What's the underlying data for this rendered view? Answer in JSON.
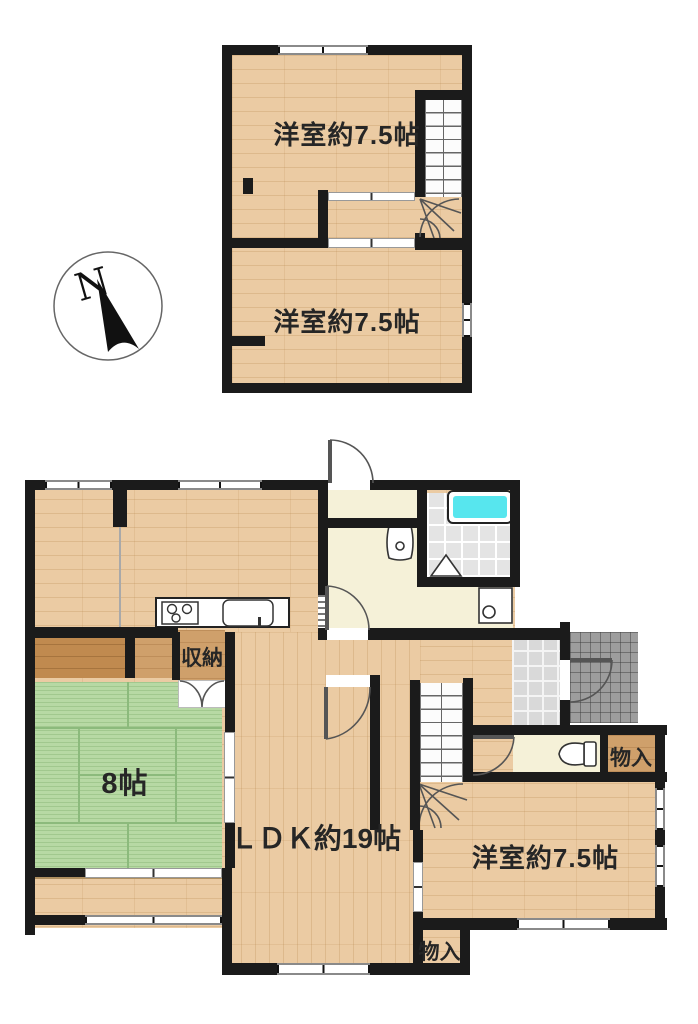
{
  "compass": {
    "label": "N"
  },
  "floor2": {
    "room_north_label": "洋室約7.5帖",
    "room_south_label": "洋室約7.5帖"
  },
  "floor1": {
    "ldk_label": "ＬＤＫ約19帖",
    "tatami_label": "8帖",
    "west_room_label": "洋室約7.5帖",
    "kitchen_storage_label": "収納",
    "closet_east_label": "物入",
    "closet_south_label": "物入"
  },
  "colors": {
    "wall": "#1b1b1b",
    "wood_floor": "#ebcba3",
    "closet_wood_dark": "#c08a4f",
    "closet_wood_mid": "#cfa06b",
    "tatami_green": "#b7d9a4",
    "room_cream": "#f5f1d8",
    "bath_tile": "#e4e4e4",
    "bathtub_cyan": "#57e6ee",
    "entrance_tile": "#d9d9d9",
    "porch_tile": "#9d9d9d"
  }
}
